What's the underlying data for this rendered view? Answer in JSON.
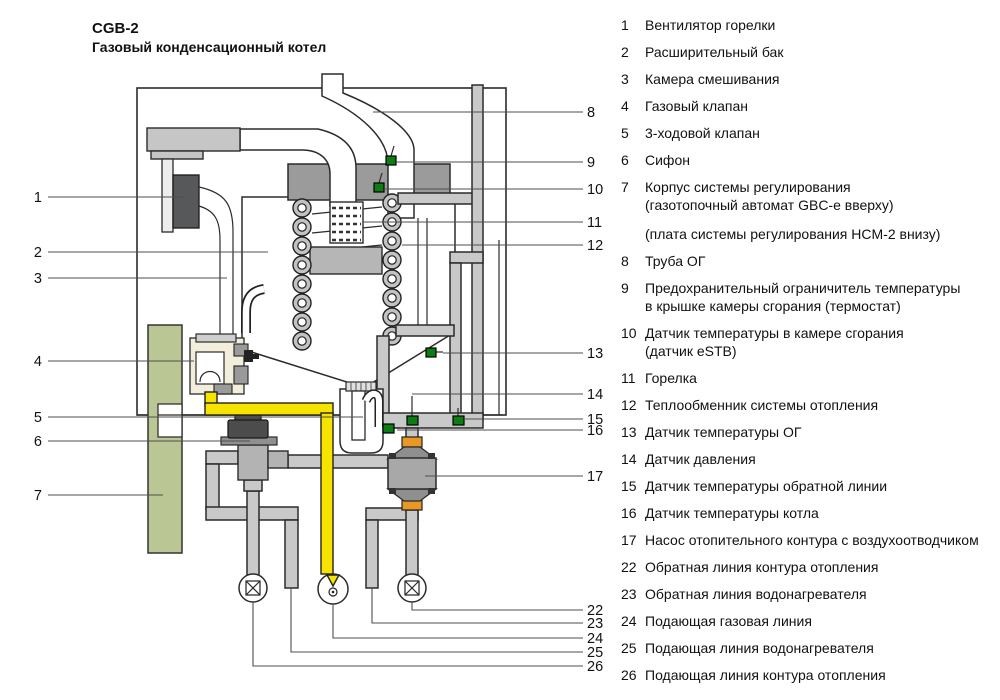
{
  "title": "CGB-2",
  "subtitle": "Газовый конденсационный котел",
  "legend": {
    "items": [
      {
        "num": "1",
        "lines": [
          "Вентилятор горелки"
        ]
      },
      {
        "num": "2",
        "lines": [
          "Расширительный бак"
        ]
      },
      {
        "num": "3",
        "lines": [
          "Камера смешивания"
        ]
      },
      {
        "num": "4",
        "lines": [
          "Газовый клапан"
        ]
      },
      {
        "num": "5",
        "lines": [
          "3-ходовой клапан"
        ]
      },
      {
        "num": "6",
        "lines": [
          "Сифон"
        ]
      },
      {
        "num": "7",
        "lines": [
          "Корпус системы регулирования",
          "(газотопочный автомат GBC-e вверху)"
        ],
        "extra": "(плата системы регулирования HCM-2 внизу)"
      },
      {
        "num": "8",
        "lines": [
          "Труба ОГ"
        ]
      },
      {
        "num": "9",
        "lines": [
          "Предохранительный ограничитель температуры",
          "в крышке камеры сгорания (термостат)"
        ]
      },
      {
        "num": "10",
        "lines": [
          "Датчик температуры в камере сгорания",
          "(датчик eSTB)"
        ]
      },
      {
        "num": "11",
        "lines": [
          "Горелка"
        ]
      },
      {
        "num": "12",
        "lines": [
          "Теплообменник системы отопления"
        ]
      },
      {
        "num": "13",
        "lines": [
          "Датчик температуры ОГ"
        ]
      },
      {
        "num": "14",
        "lines": [
          "Датчик давления"
        ]
      },
      {
        "num": "15",
        "lines": [
          "Датчик температуры обратной линии"
        ]
      },
      {
        "num": "16",
        "lines": [
          "Датчик температуры котла"
        ]
      },
      {
        "num": "17",
        "lines": [
          "Насос отопительного контура с воздухоотводчиком"
        ]
      },
      {
        "num": "22",
        "lines": [
          "Обратная линия контура отопления"
        ]
      },
      {
        "num": "23",
        "lines": [
          "Обратная линия водонагревателя"
        ]
      },
      {
        "num": "24",
        "lines": [
          "Подающая газовая линия"
        ]
      },
      {
        "num": "25",
        "lines": [
          "Подающая линия водонагревателя"
        ]
      },
      {
        "num": "26",
        "lines": [
          "Подающая линия контура отопления"
        ]
      }
    ]
  },
  "diagram": {
    "callouts_left": [
      "1",
      "2",
      "3",
      "4",
      "5",
      "6",
      "7"
    ],
    "callouts_right": [
      "8",
      "9",
      "10",
      "11",
      "12",
      "13",
      "14",
      "15",
      "16",
      "17"
    ],
    "callouts_bottom": [
      "22",
      "23",
      "24",
      "25",
      "26"
    ]
  },
  "colors": {
    "pink": "#f2b3b7",
    "green": "#bac794",
    "pipe": "#c9c9c9",
    "yellow": "#f6e300",
    "orange": "#e99824",
    "sensor": "#0e7c12",
    "cap": "#9b9b9b",
    "dark": "#4c4c4c",
    "cream": "#f2eedb",
    "pump": "#a8a8a8",
    "silver": "#c6c6c6"
  }
}
